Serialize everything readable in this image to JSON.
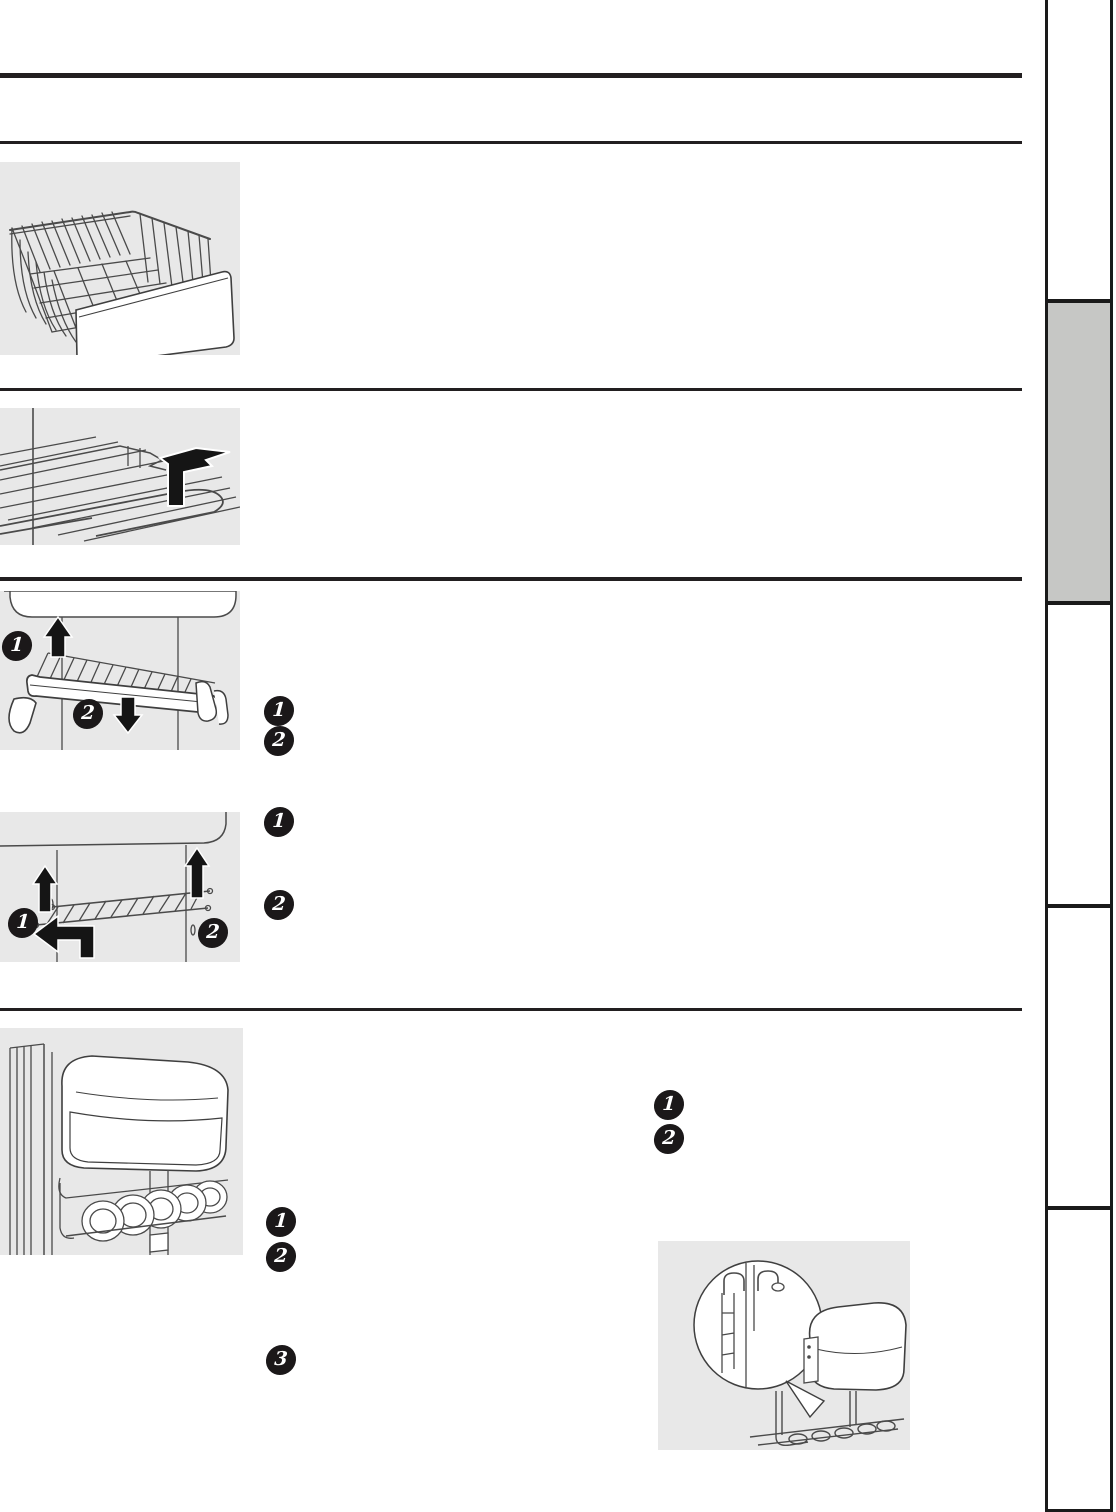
{
  "document": {
    "kind": "scanned owner's manual page",
    "visible_text_note": "only numbered step badges are legible; body text areas are blank"
  },
  "colors": {
    "page_bg": "#ffffff",
    "rule": "#221f20",
    "illustration_panel_bg": "#e8e8e8",
    "line_art": "#4a4a4a",
    "badge_bg": "#1b1819",
    "badge_text": "#ffffff",
    "sidebar_active_tab_bg": "#c6c7c5",
    "sidebar_border": "#1a1a1a"
  },
  "sidebar": {
    "tab_count": 5,
    "active_tab_index": 1
  },
  "step_badges": {
    "tilt_shelf_illustration": [
      "1",
      "2"
    ],
    "tilt_shelf_list": [
      "1",
      "2"
    ],
    "wire_rack_illustration": [
      "1",
      "2"
    ],
    "wire_rack_list": [
      "1",
      "2"
    ],
    "door_bin_list": [
      "1",
      "2"
    ],
    "can_rack_list": [
      "1",
      "2",
      "3"
    ]
  },
  "illustrations": [
    "freezer-wire-basket",
    "wire-shelf-with-lift-arrow",
    "tilt-out-shelf-remove",
    "wire-rack-replace",
    "door-bin-with-can-rack",
    "can-rack-hook-detail"
  ]
}
